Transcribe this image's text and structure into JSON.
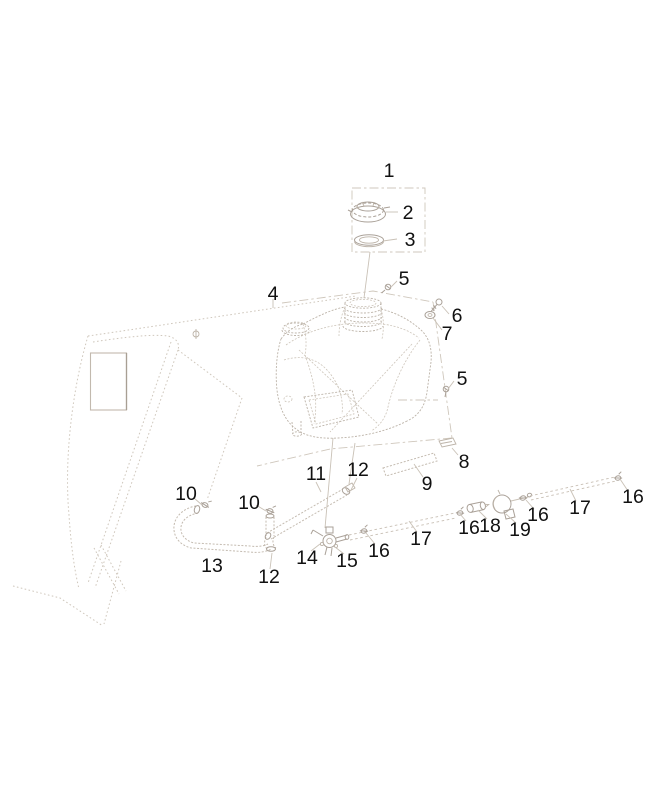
{
  "diagram": {
    "background": "#ffffff",
    "line_color": "#c4bbb0",
    "label_color": "#111111",
    "callouts": [
      {
        "ref": "1",
        "x": 389,
        "y": 177
      },
      {
        "ref": "2",
        "x": 408,
        "y": 219
      },
      {
        "ref": "3",
        "x": 410,
        "y": 246
      },
      {
        "ref": "5",
        "x": 404,
        "y": 285
      },
      {
        "ref": "4",
        "x": 273,
        "y": 300
      },
      {
        "ref": "6",
        "x": 457,
        "y": 322
      },
      {
        "ref": "7",
        "x": 447,
        "y": 340
      },
      {
        "ref": "5",
        "x": 462,
        "y": 385
      },
      {
        "ref": "8",
        "x": 464,
        "y": 468
      },
      {
        "ref": "9",
        "x": 427,
        "y": 490
      },
      {
        "ref": "11",
        "x": 316,
        "y": 480
      },
      {
        "ref": "12",
        "x": 358,
        "y": 476
      },
      {
        "ref": "10",
        "x": 186,
        "y": 500
      },
      {
        "ref": "10",
        "x": 249,
        "y": 509
      },
      {
        "ref": "13",
        "x": 212,
        "y": 572
      },
      {
        "ref": "12",
        "x": 269,
        "y": 583
      },
      {
        "ref": "14",
        "x": 307,
        "y": 564
      },
      {
        "ref": "15",
        "x": 347,
        "y": 567
      },
      {
        "ref": "16",
        "x": 379,
        "y": 557
      },
      {
        "ref": "17",
        "x": 421,
        "y": 545
      },
      {
        "ref": "16",
        "x": 469,
        "y": 534
      },
      {
        "ref": "18",
        "x": 490,
        "y": 532
      },
      {
        "ref": "19",
        "x": 520,
        "y": 536
      },
      {
        "ref": "16",
        "x": 538,
        "y": 521
      },
      {
        "ref": "17",
        "x": 580,
        "y": 514
      },
      {
        "ref": "16",
        "x": 633,
        "y": 503
      }
    ]
  }
}
